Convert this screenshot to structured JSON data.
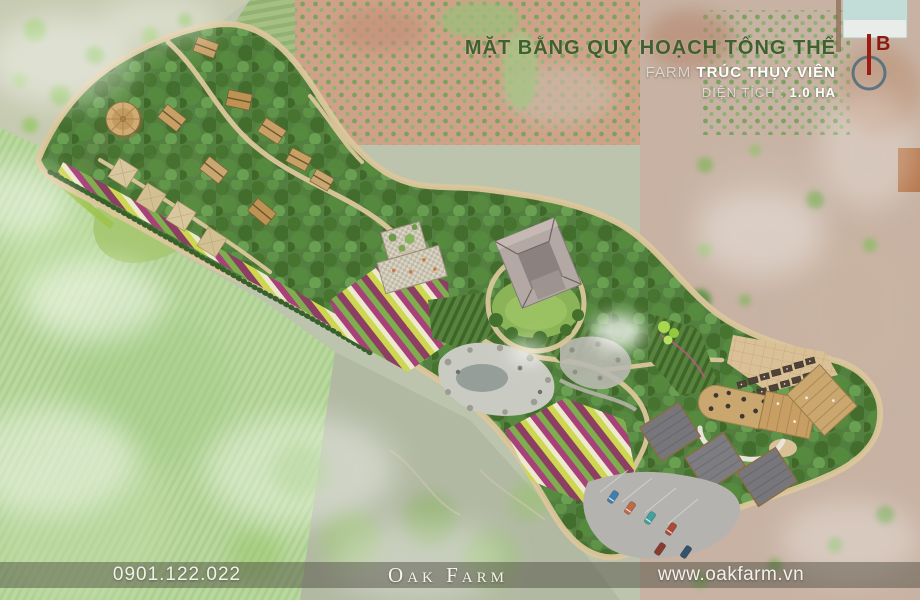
{
  "title_block": {
    "title": "MẶT BẰNG QUY HOẠCH TỔNG THỂ",
    "farm_label": "FARM",
    "farm_name": "TRÚC THỤY VIÊN",
    "area_label": "DIỆN TÍCH :",
    "area_value": "1.0 HA"
  },
  "compass": {
    "north_letter": "B"
  },
  "footer": {
    "phone": "0901.122.022",
    "brand": "Oak Farm",
    "website": "www.oakfarm.vn"
  },
  "colors": {
    "title_green": "#41602f",
    "compass_needle_red": "#9d1b12",
    "compass_ring_blue": "#50707e",
    "footer_bar": "rgba(70,68,58,0.45)",
    "footer_text": "#f2f1ea",
    "site_canopy_green": "#538040",
    "path_tan": "#dcc79c",
    "flower_magenta": "#a8417a",
    "flower_yellow": "#cdd74f"
  },
  "plan_features": {
    "legend": [
      "round-pavilion",
      "guest-cabins",
      "pyramid-tents",
      "trellis-pavilion",
      "courtyard-house",
      "event-lawn",
      "flower-fields",
      "vegetable-rows",
      "rock-pond",
      "paved-plaza",
      "pergola-terrace",
      "restaurant-building",
      "flat-roof-blocks",
      "parking-lot"
    ]
  }
}
